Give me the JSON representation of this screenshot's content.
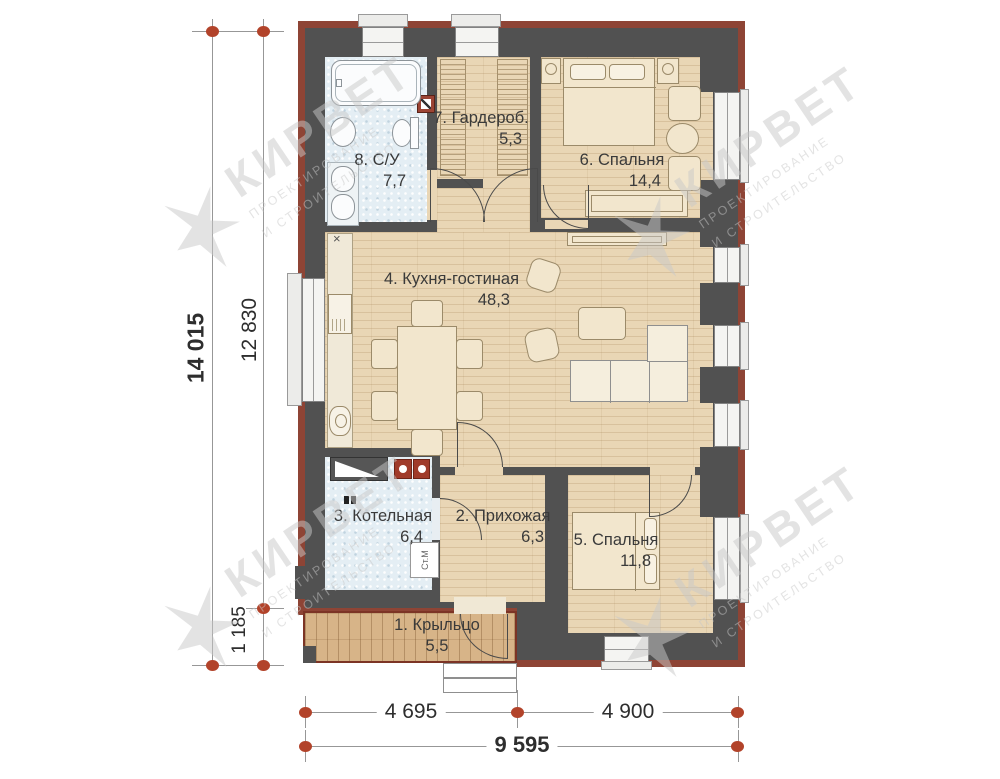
{
  "plan": {
    "rooms": [
      {
        "label": "1. Крыльцо",
        "area": "5,5"
      },
      {
        "label": "2. Прихожая",
        "area": "6,3"
      },
      {
        "label": "3. Котельная",
        "area": "6,4"
      },
      {
        "label": "4. Кухня-гостиная",
        "area": "48,3"
      },
      {
        "label": "5. Спальня",
        "area": "11,8"
      },
      {
        "label": "6. Спальня",
        "area": "14,4"
      },
      {
        "label": "7. Гардероб.",
        "area": "5,3"
      },
      {
        "label": "8. С/У",
        "area": "7,7"
      }
    ],
    "dimensions": {
      "left_total": "14 015",
      "left_main": "12 830",
      "left_porch": "1 185",
      "bottom_left": "4 695",
      "bottom_right": "4 900",
      "bottom_total": "9 595"
    },
    "labels": {
      "washing_machine": "Ст.М",
      "vent_mark": "×"
    },
    "watermark": {
      "brand": "КИРВЕТ",
      "line1": "ПРОЕКТИРОВАНИЕ",
      "line2": "И СТРОИТЕЛЬСТВО"
    },
    "colors": {
      "wall": "#515151",
      "wall_accent": "#8e4435",
      "axis_dot": "#b2432a",
      "wood_floor": "#e9d6b5",
      "wet_floor": "#e4eef4",
      "porch_wood": "#d7b488"
    }
  }
}
